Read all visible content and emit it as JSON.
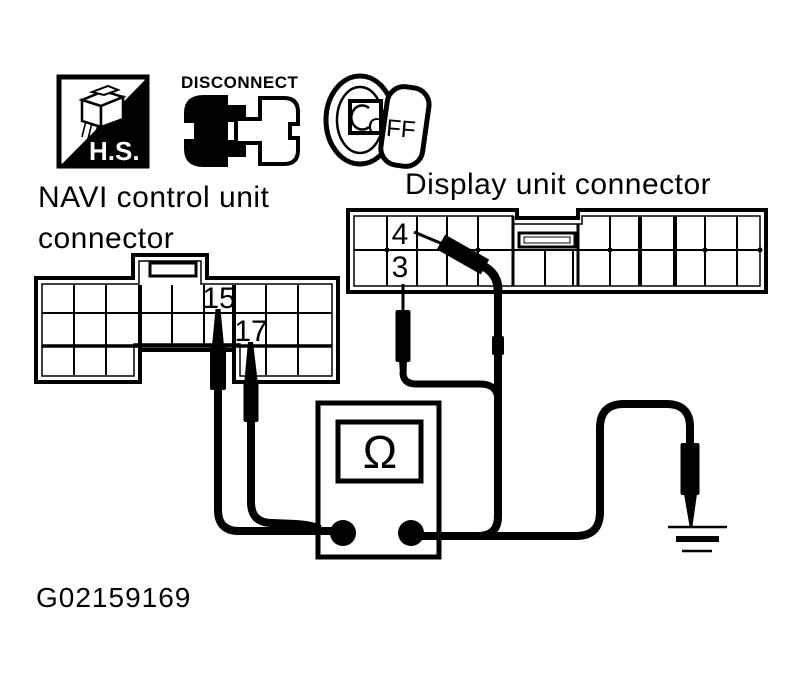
{
  "labels": {
    "hs_badge": "H.S.",
    "disconnect": "DISCONNECT",
    "key_position": "OFF",
    "navi_line1": "NAVI control unit",
    "navi_line2": "connector",
    "display": "Display unit connector",
    "ohm": "Ω",
    "figure_id": "G02159169"
  },
  "pins": {
    "navi": [
      "15",
      "17"
    ],
    "display": [
      "4",
      "3"
    ]
  },
  "icons": {
    "safety_badge": "hs-icon",
    "disconnect_connector": "disconnect-icon",
    "ignition_key": "ignition-off-icon",
    "meter_function": "ohm-symbol",
    "earth": "ground-icon"
  },
  "colors": {
    "ink": "#000000",
    "paper": "#ffffff"
  }
}
